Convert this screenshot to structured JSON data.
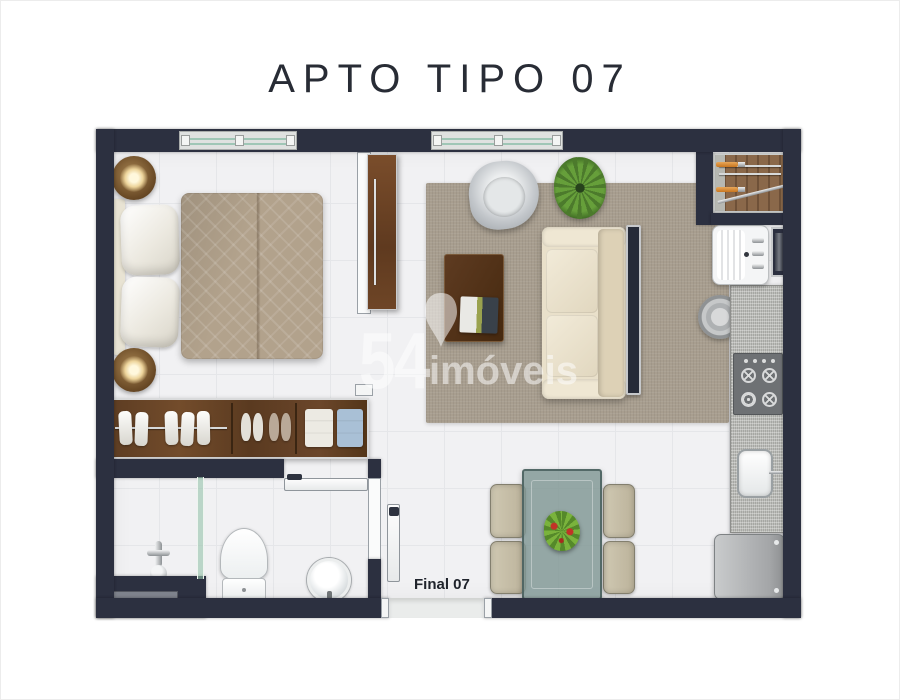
{
  "header": {
    "title": "APTO TIPO 07"
  },
  "watermark": {
    "number": "54",
    "brand": "imóveis"
  },
  "plan": {
    "entry_label": "Final 07",
    "rooms": [
      "bedroom",
      "living-room",
      "dining-area",
      "kitchen",
      "laundry",
      "bathroom",
      "hall"
    ],
    "furniture": [
      "double-bed",
      "pillows",
      "headboard",
      "nightstand-lamp",
      "wardrobe",
      "sliding-door",
      "area-rug",
      "sofa",
      "armchair",
      "potted-plant",
      "coffee-table",
      "magazine",
      "console",
      "dining-table",
      "dining-chair",
      "centerpiece-plant",
      "counter",
      "cooktop",
      "kitchen-sink",
      "refrigerator",
      "round-stool",
      "laundry-tank",
      "drying-deck",
      "service-shaft",
      "toilet",
      "shower-mixer",
      "glass-partition",
      "wall-niche",
      "vanity-basin",
      "entry-door",
      "bathroom-door",
      "window"
    ]
  },
  "colors": {
    "wall": "#2c3040",
    "floor": "#f1f1f3",
    "rug": "#a89e8f",
    "wood": "#6b4526",
    "sofa": "#e9e0ca",
    "granite": "#bcbdb9",
    "glass_table": "#7f9694",
    "accent_orange": "#d9832c",
    "plant_green": "#4c7a2c",
    "title_text": "#282c35"
  }
}
